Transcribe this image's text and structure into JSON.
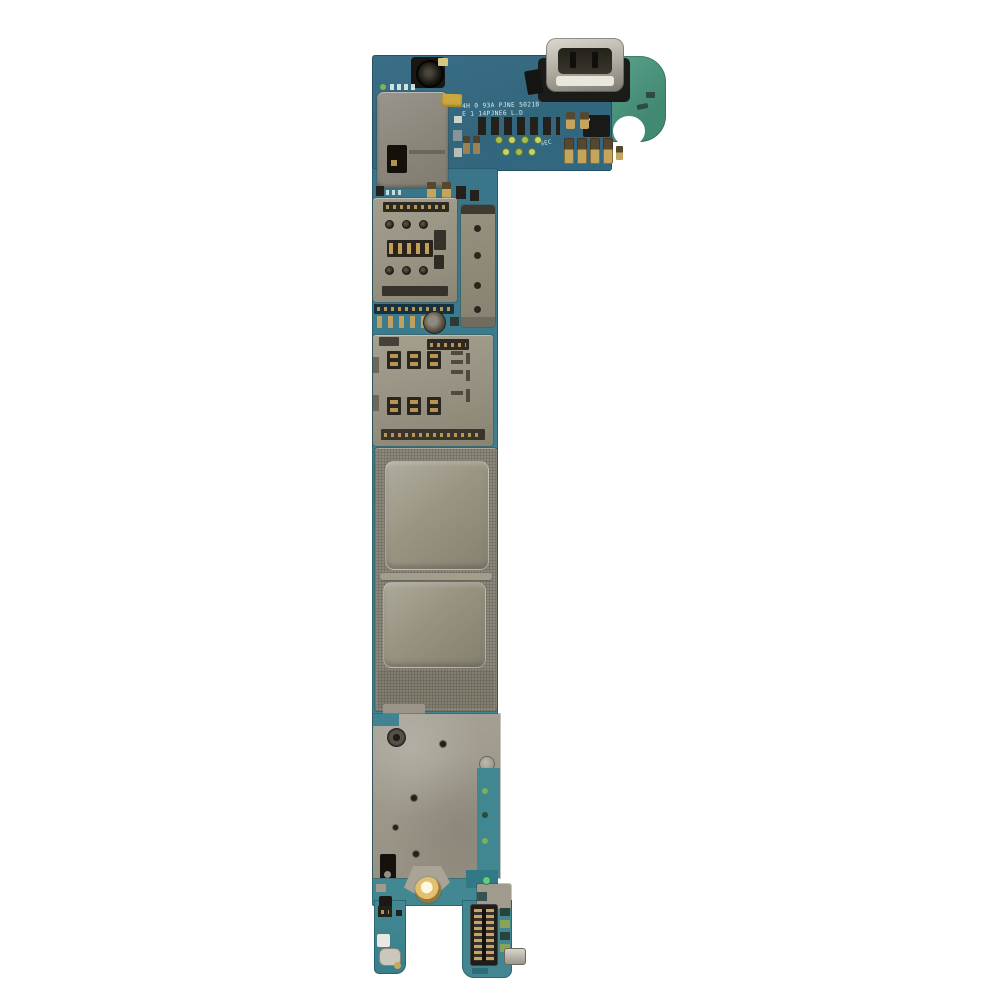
{
  "scene": {
    "type": "product-photo",
    "subject": "smartphone motherboard logic board on white background",
    "background_color": "#ffffff"
  },
  "board": {
    "silkscreen_line1": "4H 0 93A PJNE 5021B",
    "silkscreen_line2": "E 1 14PJNE6 L.D",
    "sec_marking": "SEC",
    "colors": {
      "pcb_teal": "#3a8292",
      "pcb_blue_top": "#33708a",
      "antenna_tab_green": "#4a9580",
      "shield_gray": "#8b877a",
      "shield_raised": "#a09b88",
      "rear_shield": "#9c978a",
      "socket_metal": "#9a9583",
      "slot_dark": "#2b261f",
      "gold_pad": "#c7a458",
      "connector_black": "#211d19",
      "usb_silver": "#c9c5ba",
      "sticker_yellow": "#cda83a",
      "via_green": "#a8bd4e"
    },
    "parts": [
      "micro-usb-port",
      "camera-connector",
      "top-shield-can",
      "yellow-sticker",
      "sim-socket-1",
      "sim-socket-2",
      "board-connector-strip",
      "mic-ring",
      "emi-shield-upper",
      "emi-shield-lower",
      "rear-metal-shield",
      "gold-screw-hole",
      "board-to-board-connector",
      "antenna-tab"
    ]
  }
}
